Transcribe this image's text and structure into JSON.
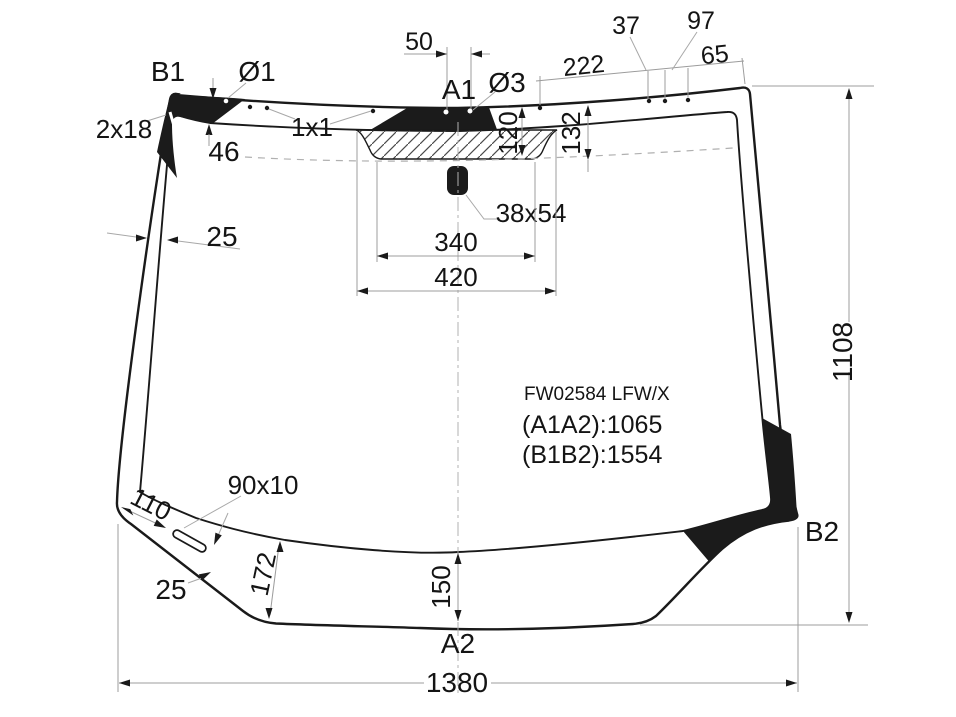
{
  "diagram": {
    "part_code": "FW02584 LFW/X",
    "measurements": {
      "a1a2": "(A1A2):1065",
      "b1b2": "(B1B2):1554"
    },
    "points": {
      "b1": "B1",
      "a1": "A1",
      "a2": "A2",
      "b2": "B2"
    },
    "dimensions": {
      "hole_d1": "Ø1",
      "hole_d3": "Ø3",
      "hole_spacing_top": "50",
      "seg_222": "222",
      "seg_37": "37",
      "seg_97": "97",
      "seg_65": "65",
      "corner_marks": "2x18",
      "dot_marks": "1x1",
      "band_top_46": "46",
      "band_side_25": "25",
      "band_h_120": "120",
      "band_h_132": "132",
      "sensor_38x54": "38x54",
      "width_340": "340",
      "width_420": "420",
      "slot_90x10": "90x10",
      "slot_offset_110": "110",
      "band_bottom_25": "25",
      "band_h_172": "172",
      "band_h_150": "150",
      "total_width": "1380",
      "total_height": "1108"
    },
    "watermark": "abcp",
    "colors": {
      "outline": "#1a1a1a",
      "band": "#1b1b1b",
      "dim_line": "#9c9c9c",
      "text": "#141414",
      "watermark": "#b6b6b6"
    }
  }
}
